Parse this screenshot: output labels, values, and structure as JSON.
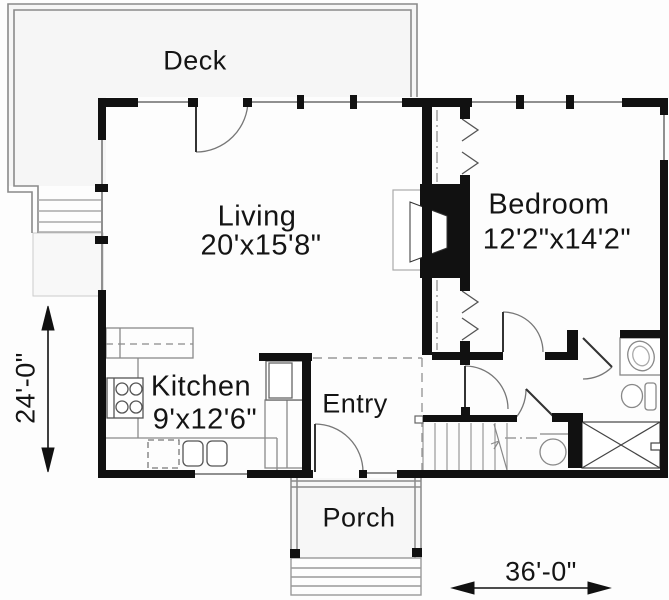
{
  "plan_title": "Floor plan",
  "rooms": {
    "deck": {
      "label": "Deck"
    },
    "living": {
      "label": "Living",
      "dims": "20'x15'8\""
    },
    "bedroom": {
      "label": "Bedroom",
      "dims": "12'2\"x14'2\""
    },
    "kitchen": {
      "label": "Kitchen",
      "dims": "9'x12'6\""
    },
    "entry": {
      "label": "Entry"
    },
    "porch": {
      "label": "Porch"
    }
  },
  "dimensions": {
    "height": "24'-0\"",
    "width": "36'-0\""
  },
  "colors": {
    "wall": "#111111",
    "thin_line": "#909090",
    "light_line": "#c8c8c8",
    "text": "#141414",
    "background": "#fdfdfd"
  },
  "fixtures": [
    "fireplace",
    "range",
    "kitchen-sink",
    "dishwasher",
    "refrigerator",
    "stairs",
    "vanity-sink",
    "toilet",
    "shower",
    "water-heater",
    "deck-stairs",
    "porch-steps"
  ]
}
